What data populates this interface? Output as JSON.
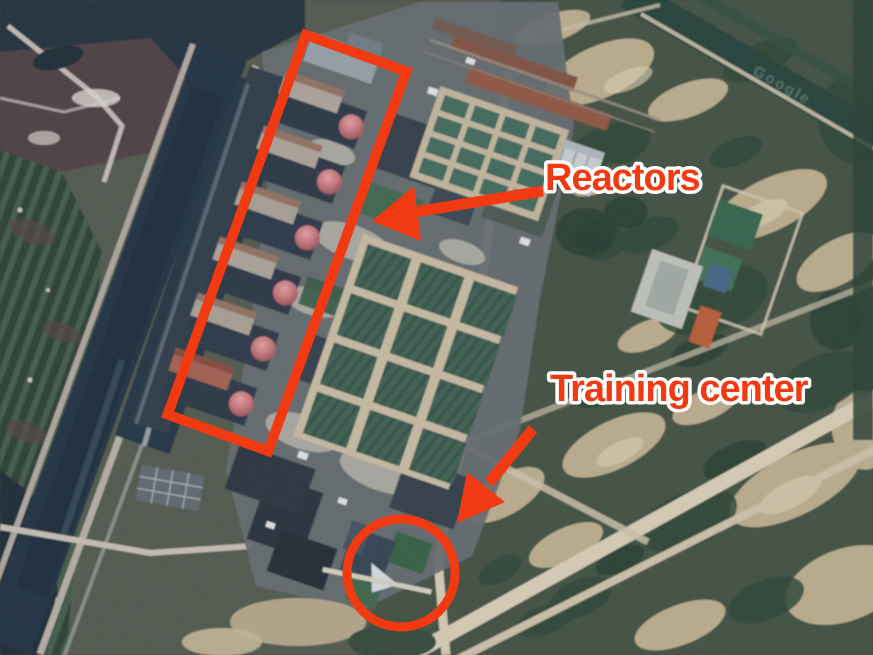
{
  "annotations": {
    "reactors": {
      "label": "Reactors"
    },
    "training_center": {
      "label": "Training center"
    },
    "accent_color": "#f23a12",
    "label_outline_color": "#ffffff"
  },
  "watermark": {
    "text": "Google"
  }
}
